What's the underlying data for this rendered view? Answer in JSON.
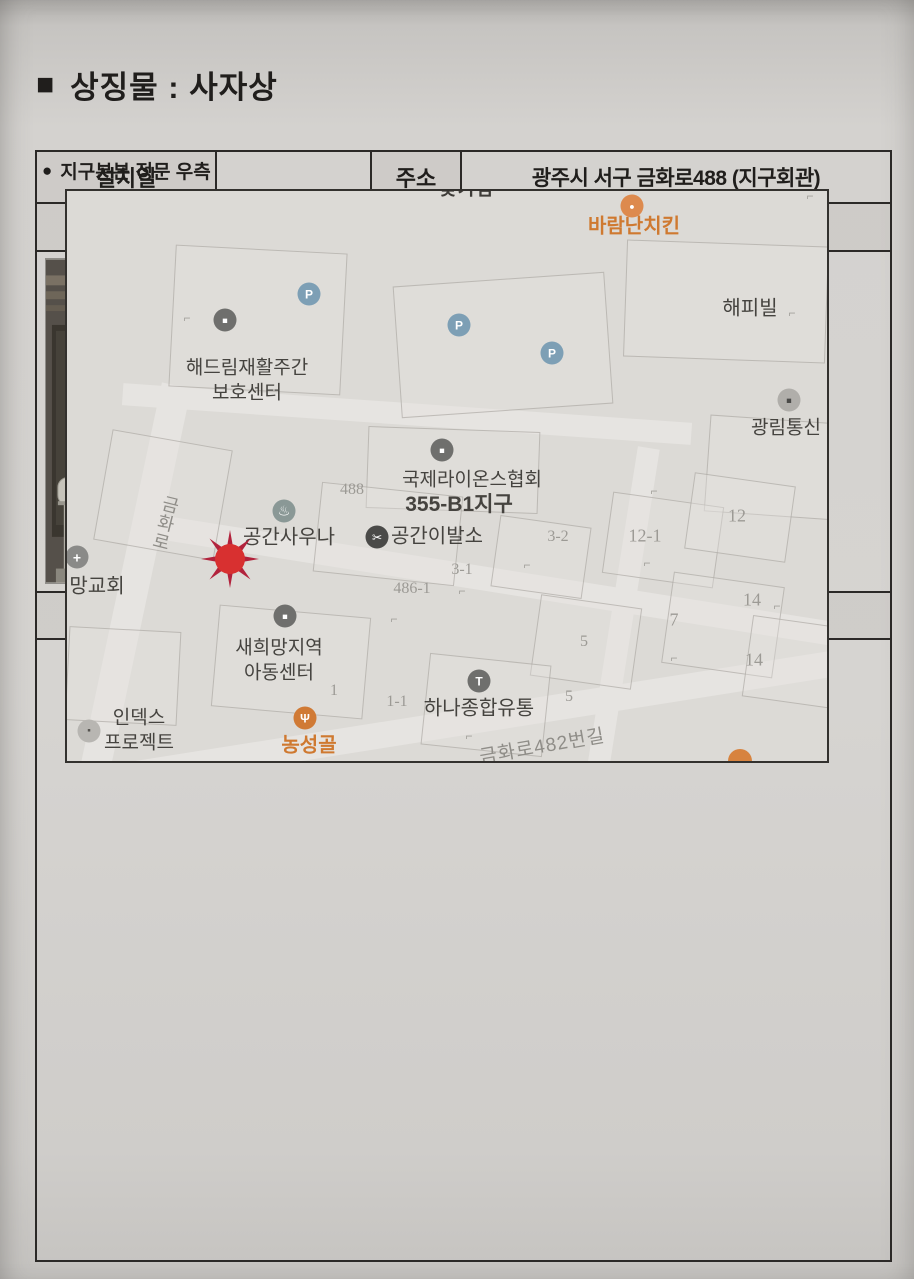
{
  "title": {
    "square": "■",
    "text": "상징물 : 사자상"
  },
  "table": {
    "install_date_label": "설치일",
    "install_date_value": "",
    "address_label": "주소",
    "address_value": "광주시 서구 금화로488 (지구회관)",
    "photo_header": "상징물 사진",
    "details_header": "상징물 내역 현황",
    "details_line1": "지구본부 정문 우측 쌍사자상이며",
    "details_line2": "상징물 설치에 대한 이력은 없음",
    "map_header": "설치 장소 세부 지도"
  },
  "map_section": {
    "bullet": "●",
    "caption": "지구본본 정문 우측"
  },
  "map": {
    "colors": {
      "bg": "#dcdad6",
      "road": "#e6e4e1",
      "number": "#9c9a95",
      "street": "#8f8d88",
      "label": "#45433f",
      "orange": "#cf7930",
      "parking_blue": "#7d9fb5",
      "marker_center": "#d83030",
      "marker_points": "#b2223c"
    },
    "corner_glyph": "⌐",
    "roads": [
      {
        "x": 52,
        "y": 190,
        "w": 30,
        "h": 410,
        "a": 12
      },
      {
        "x": -30,
        "y": 520,
        "w": 830,
        "h": 26,
        "a": -9
      },
      {
        "x": 90,
        "y": 380,
        "w": 710,
        "h": 24,
        "a": 9
      },
      {
        "x": 545,
        "y": 255,
        "w": 22,
        "h": 330,
        "a": 9
      },
      {
        "x": 55,
        "y": 212,
        "w": 570,
        "h": 22,
        "a": 4
      }
    ],
    "parcels": [
      {
        "x": 105,
        "y": 58,
        "w": 170,
        "h": 140,
        "a": 3
      },
      {
        "x": 330,
        "y": 88,
        "w": 210,
        "h": 130,
        "a": -4
      },
      {
        "x": 558,
        "y": 52,
        "w": 200,
        "h": 115,
        "a": 2
      },
      {
        "x": 640,
        "y": 228,
        "w": 130,
        "h": 95,
        "a": 4
      },
      {
        "x": 300,
        "y": 238,
        "w": 170,
        "h": 80,
        "a": 2
      },
      {
        "x": 250,
        "y": 298,
        "w": 140,
        "h": 88,
        "a": 6
      },
      {
        "x": 428,
        "y": 330,
        "w": 90,
        "h": 70,
        "a": 8
      },
      {
        "x": 540,
        "y": 308,
        "w": 110,
        "h": 80,
        "a": 8
      },
      {
        "x": 622,
        "y": 288,
        "w": 100,
        "h": 75,
        "a": 8
      },
      {
        "x": 468,
        "y": 410,
        "w": 100,
        "h": 80,
        "a": 8
      },
      {
        "x": 600,
        "y": 388,
        "w": 110,
        "h": 90,
        "a": 8
      },
      {
        "x": 680,
        "y": 430,
        "w": 90,
        "h": 80,
        "a": 8
      },
      {
        "x": 148,
        "y": 420,
        "w": 150,
        "h": 100,
        "a": 5
      },
      {
        "x": 358,
        "y": 468,
        "w": 120,
        "h": 90,
        "a": 6
      },
      {
        "x": 35,
        "y": 248,
        "w": 120,
        "h": 110,
        "a": 10
      },
      {
        "x": 0,
        "y": 438,
        "w": 110,
        "h": 92,
        "a": 3
      }
    ],
    "corner_marks": [
      [
        120,
        127
      ],
      [
        725,
        122
      ],
      [
        587,
        300
      ],
      [
        460,
        374
      ],
      [
        395,
        400
      ],
      [
        327,
        428
      ],
      [
        710,
        415
      ],
      [
        607,
        467
      ],
      [
        402,
        545
      ],
      [
        580,
        372
      ],
      [
        743,
        5
      ]
    ],
    "numbers": [
      {
        "t": "488",
        "x": 285,
        "y": 299
      },
      {
        "t": "3-2",
        "x": 491,
        "y": 346
      },
      {
        "t": "12-1",
        "x": 578,
        "y": 345,
        "s": 18
      },
      {
        "t": "12",
        "x": 670,
        "y": 325,
        "s": 18
      },
      {
        "t": "3-1",
        "x": 395,
        "y": 379
      },
      {
        "t": "486-1",
        "x": 345,
        "y": 398
      },
      {
        "t": "14",
        "x": 685,
        "y": 409,
        "s": 18
      },
      {
        "t": "7",
        "x": 607,
        "y": 429,
        "s": 18
      },
      {
        "t": "5",
        "x": 517,
        "y": 451
      },
      {
        "t": "14",
        "x": 687,
        "y": 469,
        "s": 18
      },
      {
        "t": "5",
        "x": 502,
        "y": 506
      },
      {
        "t": "1",
        "x": 267,
        "y": 500
      },
      {
        "t": "1-1",
        "x": 330,
        "y": 511
      }
    ],
    "streets": [
      {
        "t": "꽃가람",
        "x": 400,
        "y": -4,
        "s": 19,
        "c": "#3e3c38",
        "b": true
      },
      {
        "t": "금화로",
        "x": 98,
        "y": 332,
        "vertical": true,
        "a": 14,
        "s": 18
      },
      {
        "t": "금화로482번길",
        "x": 475,
        "y": 554,
        "a": -10,
        "s": 19
      }
    ],
    "pois": [
      {
        "name": "baramnan-chicken",
        "icon": {
          "x": 565,
          "y": 15,
          "bg": "#dd8a4e",
          "char": "●",
          "fs": 9
        },
        "label": {
          "x": 567,
          "y": 36,
          "lines": [
            "바람난치킨"
          ],
          "c": "#cf7930",
          "s": 20,
          "b": true
        }
      },
      {
        "name": "happy-ville",
        "label": {
          "x": 683,
          "y": 118,
          "lines": [
            "해피빌"
          ],
          "s": 20
        }
      },
      {
        "name": "parking-1",
        "icon": {
          "x": 242,
          "y": 103,
          "bg": "#7d9fb5",
          "char": "P"
        }
      },
      {
        "name": "parking-2",
        "icon": {
          "x": 392,
          "y": 134,
          "bg": "#7d9fb5",
          "char": "P"
        }
      },
      {
        "name": "parking-3",
        "icon": {
          "x": 485,
          "y": 162,
          "bg": "#7d9fb5",
          "char": "P"
        }
      },
      {
        "name": "haedream-center",
        "icon": {
          "x": 158,
          "y": 129,
          "bg": "#6f6f6d",
          "char": "■",
          "fs": 9
        },
        "label": {
          "x": 180,
          "y": 190,
          "lines": [
            "해드림재활주간",
            "보호센터"
          ]
        }
      },
      {
        "name": "gwanglim-telecom",
        "icon": {
          "x": 722,
          "y": 209,
          "bg": "#b0aeaa",
          "char": "■",
          "fg": "#4a4a48",
          "fs": 9
        },
        "label": {
          "x": 719,
          "y": 237,
          "lines": [
            "광림통신"
          ]
        }
      },
      {
        "name": "lions-club",
        "icon": {
          "x": 375,
          "y": 259,
          "bg": "#6f6f6d",
          "char": "■",
          "fs": 9
        },
        "label": {
          "x": 405,
          "y": 289,
          "lines": [
            "국제라이온스협회"
          ]
        }
      },
      {
        "name": "lions-club-district",
        "label": {
          "x": 392,
          "y": 314,
          "lines": [
            "355-B1지구"
          ],
          "s": 21,
          "b": true
        }
      },
      {
        "name": "gonggan-sauna",
        "icon": {
          "x": 217,
          "y": 320,
          "bg": "#8a9896",
          "char": "♨",
          "fs": 14
        },
        "label": {
          "x": 222,
          "y": 347,
          "lines": [
            "공간사우나"
          ],
          "s": 20
        }
      },
      {
        "name": "gonggan-barber",
        "icon": {
          "x": 310,
          "y": 346,
          "bg": "#4a4a48",
          "char": "✂",
          "fs": 12
        },
        "label": {
          "x": 370,
          "y": 346,
          "lines": [
            "공간이발소"
          ],
          "s": 20
        }
      },
      {
        "name": "mang-church",
        "icon": {
          "x": 10,
          "y": 366,
          "bg": "#8a8a88",
          "char": "+",
          "fs": 14
        },
        "label": {
          "x": 30,
          "y": 396,
          "lines": [
            "망교회"
          ],
          "s": 20
        }
      },
      {
        "name": "saehuimang-childrens-center",
        "icon": {
          "x": 218,
          "y": 425,
          "bg": "#6f6f6d",
          "char": "■",
          "fs": 9
        },
        "label": {
          "x": 212,
          "y": 470,
          "lines": [
            "새희망지역",
            "아동센터"
          ]
        }
      },
      {
        "name": "index-project",
        "icon": {
          "x": 22,
          "y": 540,
          "bg": "#b8b6b2",
          "char": "▪",
          "fg": "#55534f",
          "fs": 10
        },
        "label": {
          "x": 72,
          "y": 540,
          "lines": [
            "인덱스",
            "프로젝트"
          ]
        }
      },
      {
        "name": "nongseonggol",
        "icon": {
          "x": 238,
          "y": 527,
          "bg": "#d07a35",
          "char": "Ψ",
          "fs": 12
        },
        "label": {
          "x": 242,
          "y": 555,
          "lines": [
            "농성골"
          ],
          "c": "#cf7930",
          "s": 20,
          "b": true
        }
      },
      {
        "name": "hana-distribution",
        "icon": {
          "x": 412,
          "y": 490,
          "bg": "#6f6f6d",
          "char": "T",
          "fs": 12
        },
        "label": {
          "x": 412,
          "y": 518,
          "lines": [
            "하나종합유통"
          ],
          "s": 20
        }
      }
    ],
    "marker": {
      "x": 163,
      "y": 368,
      "center_color": "#d83030",
      "point_color": "#b2223c"
    },
    "partials": [
      {
        "x": 673,
        "y": 570,
        "r": 12,
        "color": "#d7833f"
      }
    ]
  }
}
